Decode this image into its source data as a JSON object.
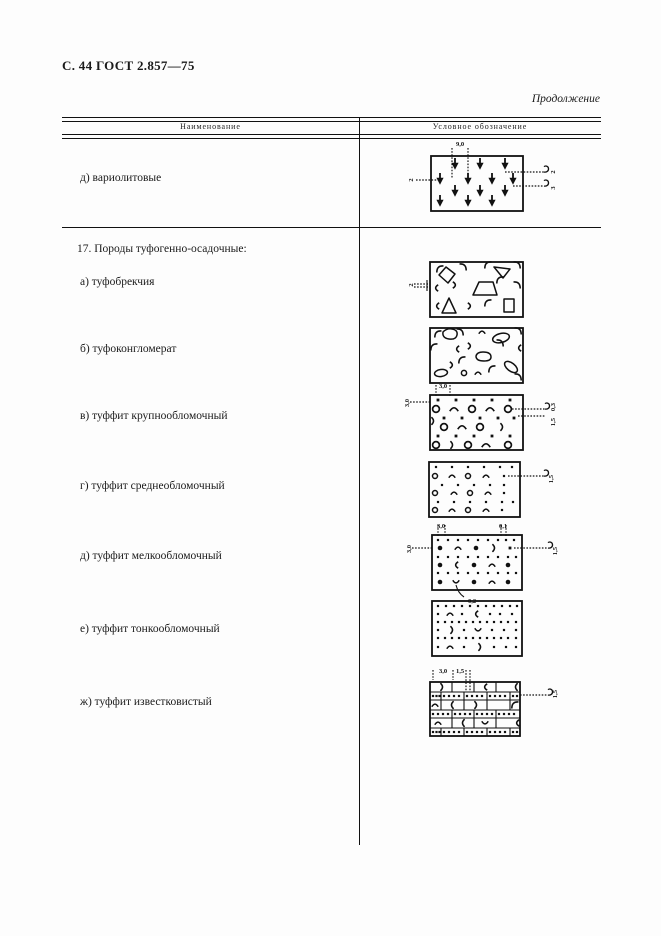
{
  "page": {
    "header": "С. 44 ГОСТ 2.857—75",
    "continuation": "Продолжение"
  },
  "table": {
    "col1": "Наименование",
    "col2": "Условное обозначение"
  },
  "rows": [
    {
      "label": "д)  вариолитовые",
      "ann": {
        "top": "9,0",
        "left": "2",
        "r1": "2",
        "r2": "3"
      }
    },
    {
      "label": "17. Породы туфогенно-осадочные:"
    },
    {
      "label": "а)  туфобрекчия",
      "ann": {
        "left": "2"
      }
    },
    {
      "label": "б)  туфоконгломерат"
    },
    {
      "label": "в)  туффит  крупнообломочный",
      "ann": {
        "top": "3,0",
        "left": "3,0",
        "r1": "0,3",
        "r2": "1,5"
      }
    },
    {
      "label": "г)  туффит  среднеобломочный",
      "ann": {
        "right": "1,5"
      }
    },
    {
      "label": "д)  туффит  мелкообломочный",
      "ann": {
        "tl": "3,0",
        "tr": "0,1",
        "left": "3,0",
        "right": "1,5",
        "bottom": "0,2"
      }
    },
    {
      "label": "е)  туффит  тонкообломочный"
    },
    {
      "label": "ж)  туффит  известковистый",
      "ann": {
        "t1": "3,0",
        "t2": "1,5",
        "right": "1,5"
      }
    }
  ]
}
